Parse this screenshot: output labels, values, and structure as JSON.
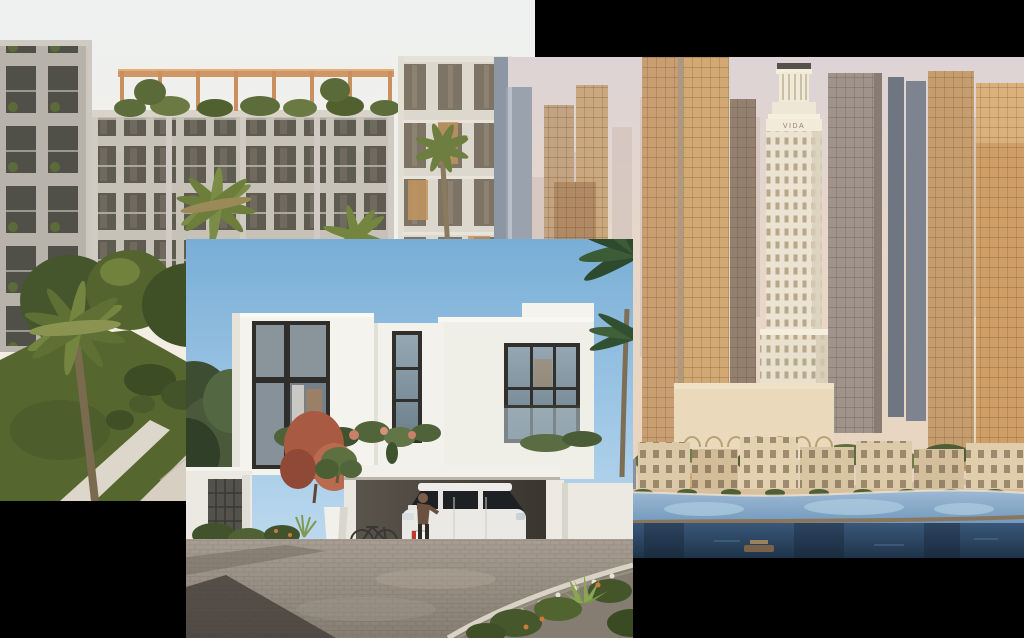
{
  "canvas": {
    "width_px": 1024,
    "height_px": 638,
    "background_color": "#000000"
  },
  "collage": {
    "photo_count": 3,
    "photos": [
      {
        "id": "apartment-courtyard",
        "description": "Rendering of modern low-rise apartment buildings with rooftop timber pergolas around a palm-filled courtyard, lawn, walkway and turquoise swimming pool at dusk",
        "left_px": 0,
        "top_px": 0,
        "width_px": 535,
        "height_px": 501,
        "palette": {
          "sky": "#f0f2ef",
          "facade": "#c5c1b7",
          "pergola": "#d09766",
          "foliage": "#50602f",
          "pool": "#8fccbd"
        }
      },
      {
        "id": "city-skyline-waterfront",
        "description": "Aerial rendering of a sunset high-rise district with a white classical landmark tower, cream mid-rise blocks, palm promenade, lagoon pools, beach and dark creek water",
        "sign_text": "VIDA",
        "left_px": 494,
        "top_px": 57,
        "width_px": 530,
        "height_px": 501,
        "palette": {
          "sky": "#ddd3d4",
          "warm_towers": "#cda572",
          "landmark": "#ece3d2",
          "lagoon": "#7ea4c6",
          "creek": "#2c4763"
        }
      },
      {
        "id": "villa-driveway",
        "description": "Rendering of a white contemporary two-storey villa with dark-framed glazing, flowering creeper, carport with a white SUV, person, bicycle, planter and paved driveway under a clear blue sky",
        "left_px": 186,
        "top_px": 239,
        "width_px": 447,
        "height_px": 399,
        "palette": {
          "sky": "#7dadd6",
          "walls": "#f2f1eb",
          "frames": "#2f2e2a",
          "paving": "#978d83",
          "planting": "#4f6135"
        }
      }
    ]
  }
}
